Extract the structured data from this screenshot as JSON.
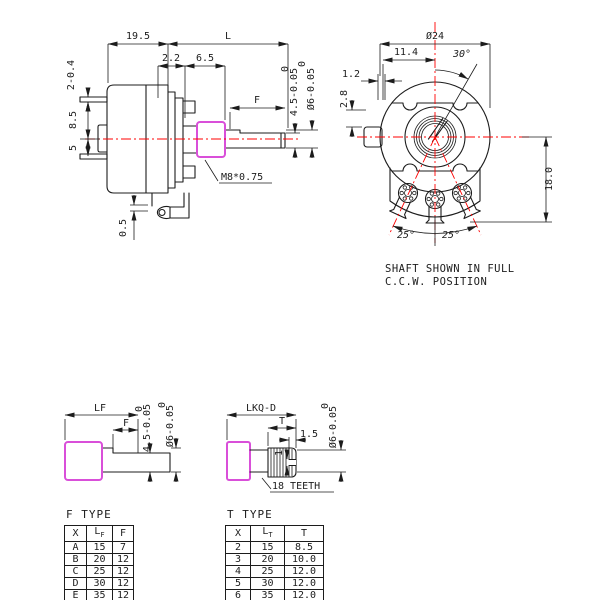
{
  "drawing": {
    "side_view": {
      "dim_19_5": "19.5",
      "dim_L": "L",
      "dim_2_2": "2.2",
      "dim_6_5": "6.5",
      "dim_pin": "2-0.4",
      "dim_8_5": "8.5",
      "dim_5": "5",
      "dim_F": "F",
      "flat_tol_upper": "0",
      "flat_dim": "4.5-0.05",
      "shaft_tol_upper": "0",
      "shaft_dim": "Ø6-0.05",
      "thread_label": "M8*0.75",
      "dim_0_5": "0.5"
    },
    "front_view": {
      "dim_dia": "Ø24",
      "dim_11_4": "11.4",
      "dim_30": "30°",
      "dim_1_2": "1.2",
      "dim_2_8": "2.8",
      "dim_18": "18.0",
      "dim_25_l": "25°",
      "dim_25_r": "25°",
      "note_line1": "SHAFT SHOWN IN FULL",
      "note_line2": "C.C.W. POSITION"
    },
    "f_shaft_detail": {
      "dim_LF": "LF",
      "dim_F": "F",
      "flat_tol_upper": "0",
      "flat_dim": "4.5-0.05",
      "shaft_tol_upper": "0",
      "shaft_dim": "Ø6-0.05"
    },
    "t_shaft_detail": {
      "dim_len": "LKQ-D",
      "dim_T": "T",
      "dim_1_5": "1.5",
      "dim_1": "1",
      "shaft_tol_upper": "0",
      "shaft_dim": "Ø6-0.05",
      "teeth_note": "18 TEETH"
    }
  },
  "tables": {
    "f_type": {
      "title": "F TYPE",
      "col1": "X",
      "col2_main": "L",
      "col2_sub": "F",
      "col3": "F",
      "rows": [
        [
          "A",
          "15",
          "7"
        ],
        [
          "B",
          "20",
          "12"
        ],
        [
          "C",
          "25",
          "12"
        ],
        [
          "D",
          "30",
          "12"
        ],
        [
          "E",
          "35",
          "12"
        ]
      ]
    },
    "t_type": {
      "title": "T TYPE",
      "col1": "X",
      "col2_main": "L",
      "col2_sub": "T",
      "col3": "T",
      "rows": [
        [
          "2",
          "15",
          "8.5"
        ],
        [
          "3",
          "20",
          "10.0"
        ],
        [
          "4",
          "25",
          "12.0"
        ],
        [
          "5",
          "30",
          "12.0"
        ],
        [
          "6",
          "35",
          "12.0"
        ]
      ]
    }
  },
  "colors": {
    "line": "#1c1c1c",
    "centerline": "#ff0000",
    "highlight": "#d94fd9"
  }
}
